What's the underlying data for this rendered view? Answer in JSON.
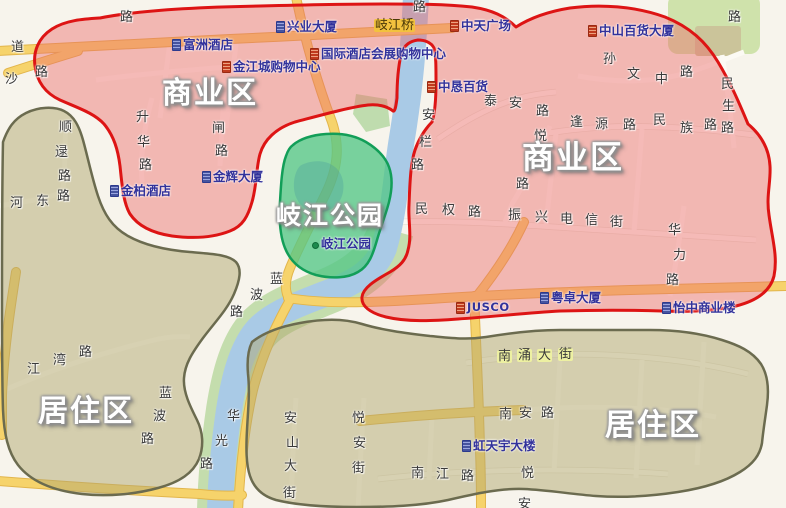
{
  "image": {
    "width": 786,
    "height": 508,
    "kind": "annotated city map"
  },
  "zones": [
    {
      "id": "commercial",
      "label": "商业区",
      "fill": "rgba(236,105,105,0.44)",
      "outline": "#dd1414"
    },
    {
      "id": "residential",
      "label": "居住区",
      "fill": "rgba(178,168,112,0.5)",
      "outline": "#6b6b4f"
    },
    {
      "id": "park",
      "label": "岐江公园",
      "fill": "rgba(85,198,135,0.78)",
      "outline": "#129e58"
    }
  ],
  "palette": {
    "background": "#f7f4ec",
    "river": "#a9cae6",
    "river_bank": "#c4ddad",
    "major_road": "#f6d36b",
    "major_road_edge": "#e2b54b",
    "minor_road": "#fcfaf4",
    "poi_text": "#32329b",
    "road_text": "#3a3a3a",
    "green_block": "#cfe2ab"
  },
  "map": {
    "zone_labels": [
      {
        "name": "zone-label-commercial-west",
        "text": "商业区",
        "x": 162,
        "y": 79,
        "size": 30
      },
      {
        "name": "zone-label-commercial-east",
        "text": "商业区",
        "x": 522,
        "y": 141,
        "size": 32
      },
      {
        "name": "zone-label-qijiang-park",
        "text": "岐江公园",
        "x": 276,
        "y": 203,
        "size": 25
      },
      {
        "name": "zone-label-residential-west",
        "text": "居住区",
        "x": 38,
        "y": 397,
        "size": 30
      },
      {
        "name": "zone-label-residential-east",
        "text": "居住区",
        "x": 605,
        "y": 411,
        "size": 30
      }
    ],
    "bridge_label": {
      "name": "bridge-label-qijiangqiao",
      "text": "岐江桥",
      "chars": [
        [
          374,
          19
        ],
        [
          387,
          19
        ],
        [
          400,
          19
        ]
      ],
      "bg": "#f2c23e",
      "color": "#4a3808"
    },
    "road_labels": [
      {
        "name": "road-label-lu-topleft",
        "text": "路",
        "chars": [
          [
            120,
            11
          ]
        ]
      },
      {
        "name": "road-label-dao",
        "text": "道",
        "chars": [
          [
            11,
            41
          ]
        ]
      },
      {
        "name": "road-label-sha-lu",
        "text": "沙路",
        "chars": [
          [
            5,
            73
          ],
          [
            35,
            66
          ]
        ]
      },
      {
        "name": "road-label-shunlu-lu",
        "text": "顺逯路",
        "chars": [
          [
            59,
            121
          ],
          [
            55,
            146
          ],
          [
            58,
            170
          ]
        ]
      },
      {
        "name": "road-label-hedong-lu",
        "text": "河东路",
        "chars": [
          [
            10,
            197
          ],
          [
            36,
            195
          ],
          [
            57,
            190
          ]
        ]
      },
      {
        "name": "road-label-shenghua-lu",
        "text": "升华路",
        "chars": [
          [
            136,
            111
          ],
          [
            137,
            136
          ],
          [
            139,
            159
          ]
        ]
      },
      {
        "name": "road-label-zha-lu",
        "text": "闸路",
        "chars": [
          [
            212,
            122
          ],
          [
            215,
            145
          ]
        ]
      },
      {
        "name": "road-label-jiangwan-lu",
        "text": "江湾路",
        "chars": [
          [
            27,
            363
          ],
          [
            53,
            354
          ],
          [
            79,
            346
          ]
        ]
      },
      {
        "name": "road-label-lanbo-lu-north",
        "text": "蓝波路",
        "chars": [
          [
            270,
            273
          ],
          [
            250,
            289
          ],
          [
            230,
            306
          ]
        ]
      },
      {
        "name": "road-label-lanbo-lu-south",
        "text": "蓝波路",
        "chars": [
          [
            159,
            387
          ],
          [
            153,
            410
          ],
          [
            141,
            433
          ]
        ]
      },
      {
        "name": "road-label-huaguang-lu",
        "text": "华光路",
        "chars": [
          [
            227,
            410
          ],
          [
            215,
            435
          ],
          [
            200,
            458
          ]
        ]
      },
      {
        "name": "road-label-anshan-dajie",
        "text": "安山大街",
        "chars": [
          [
            284,
            412
          ],
          [
            286,
            437
          ],
          [
            284,
            460
          ],
          [
            283,
            487
          ]
        ]
      },
      {
        "name": "road-label-yuean-jie",
        "text": "悦安街",
        "chars": [
          [
            352,
            412
          ],
          [
            353,
            437
          ],
          [
            352,
            462
          ]
        ]
      },
      {
        "name": "road-label-nanjiang-lu",
        "text": "南江路",
        "chars": [
          [
            411,
            467
          ],
          [
            436,
            468
          ],
          [
            461,
            470
          ]
        ]
      },
      {
        "name": "road-label-yue-an",
        "text": "悦安",
        "chars": [
          [
            521,
            467
          ],
          [
            518,
            498
          ]
        ]
      },
      {
        "name": "road-label-nanan-lu",
        "text": "南安路",
        "chars": [
          [
            499,
            408
          ],
          [
            519,
            407
          ],
          [
            541,
            407
          ]
        ]
      },
      {
        "name": "road-label-nanyong-dajie",
        "text": "南涌大街",
        "chars": [
          [
            497,
            350
          ],
          [
            517,
            349
          ],
          [
            537,
            349
          ],
          [
            558,
            348
          ]
        ],
        "bg": "#edf0a2"
      },
      {
        "name": "road-label-taian-lu",
        "text": "泰安路",
        "chars": [
          [
            484,
            95
          ],
          [
            509,
            97
          ],
          [
            536,
            105
          ]
        ]
      },
      {
        "name": "road-label-fengyuan-lu",
        "text": "逢源路",
        "chars": [
          [
            570,
            116
          ],
          [
            595,
            118
          ],
          [
            623,
            119
          ]
        ]
      },
      {
        "name": "road-label-minzu-lu",
        "text": "民族路",
        "chars": [
          [
            653,
            114
          ],
          [
            680,
            122
          ],
          [
            704,
            119
          ]
        ]
      },
      {
        "name": "road-label-minsheng-lu",
        "text": "民生路",
        "chars": [
          [
            721,
            78
          ],
          [
            722,
            100
          ],
          [
            721,
            122
          ]
        ]
      },
      {
        "name": "road-label-sunwen-zhonglu",
        "text": "孙文中路",
        "chars": [
          [
            603,
            53
          ],
          [
            627,
            68
          ],
          [
            655,
            73
          ],
          [
            680,
            66
          ]
        ]
      },
      {
        "name": "road-label-yuelai-lu",
        "text": "悦来路",
        "chars": [
          [
            534,
            130
          ],
          [
            528,
            157
          ],
          [
            516,
            178
          ]
        ]
      },
      {
        "name": "road-label-anlan-lu",
        "text": "安栏路",
        "chars": [
          [
            422,
            109
          ],
          [
            419,
            136
          ],
          [
            411,
            159
          ]
        ]
      },
      {
        "name": "road-label-minquan-lu",
        "text": "民权路",
        "chars": [
          [
            415,
            203
          ],
          [
            442,
            204
          ],
          [
            468,
            206
          ]
        ]
      },
      {
        "name": "road-label-zhenxing-dianxin-jie",
        "text": "振兴电信街",
        "chars": [
          [
            508,
            209
          ],
          [
            535,
            211
          ],
          [
            560,
            213
          ],
          [
            585,
            214
          ],
          [
            610,
            216
          ]
        ]
      },
      {
        "name": "road-label-huali-lu",
        "text": "华力路",
        "chars": [
          [
            668,
            224
          ],
          [
            673,
            249
          ],
          [
            666,
            274
          ]
        ]
      },
      {
        "name": "road-label-lu-topright",
        "text": "路",
        "chars": [
          [
            728,
            11
          ]
        ]
      },
      {
        "name": "road-label-lu-bridge",
        "text": "路",
        "chars": [
          [
            413,
            1
          ]
        ]
      }
    ],
    "poi_labels": [
      {
        "name": "poi-fuzhou-hotel",
        "text": "富洲酒店",
        "x": 172,
        "y": 39,
        "icon": "blue"
      },
      {
        "name": "poi-jinjiangcheng-mall",
        "text": "金江城购物中心",
        "x": 222,
        "y": 61,
        "icon": "red"
      },
      {
        "name": "poi-intl-hotel-expo-mall",
        "text": "国际酒店会展购物中心",
        "x": 310,
        "y": 48,
        "icon": "red"
      },
      {
        "name": "poi-xingye-building",
        "text": "兴业大厦",
        "x": 276,
        "y": 21,
        "icon": "blue"
      },
      {
        "name": "poi-zhongtian-plaza",
        "text": "中天广场",
        "x": 450,
        "y": 20,
        "icon": "red"
      },
      {
        "name": "poi-zhongshan-dept-store",
        "text": "中山百货大厦",
        "x": 588,
        "y": 25,
        "icon": "red"
      },
      {
        "name": "poi-zhongken-dept-store",
        "text": "中恳百货",
        "x": 427,
        "y": 81,
        "icon": "red"
      },
      {
        "name": "poi-jinbai-hotel",
        "text": "金柏酒店",
        "x": 110,
        "y": 185,
        "icon": "blue"
      },
      {
        "name": "poi-jinhui-building",
        "text": "金辉大厦",
        "x": 202,
        "y": 171,
        "icon": "blue"
      },
      {
        "name": "poi-jusco",
        "text": "JUSCO",
        "x": 456,
        "y": 302,
        "icon": "red",
        "latin": true
      },
      {
        "name": "poi-yuezhuo-building",
        "text": "粤卓大厦",
        "x": 540,
        "y": 292,
        "icon": "blue"
      },
      {
        "name": "poi-yizhong-commercial-building",
        "text": "怡中商业楼",
        "x": 662,
        "y": 302,
        "icon": "blue"
      },
      {
        "name": "poi-hongtianyu-building",
        "text": "虹天宇大楼",
        "x": 462,
        "y": 440,
        "icon": "blue"
      },
      {
        "name": "poi-qijiang-park",
        "text": "岐江公园",
        "x": 312,
        "y": 238,
        "icon": "dot"
      }
    ]
  }
}
